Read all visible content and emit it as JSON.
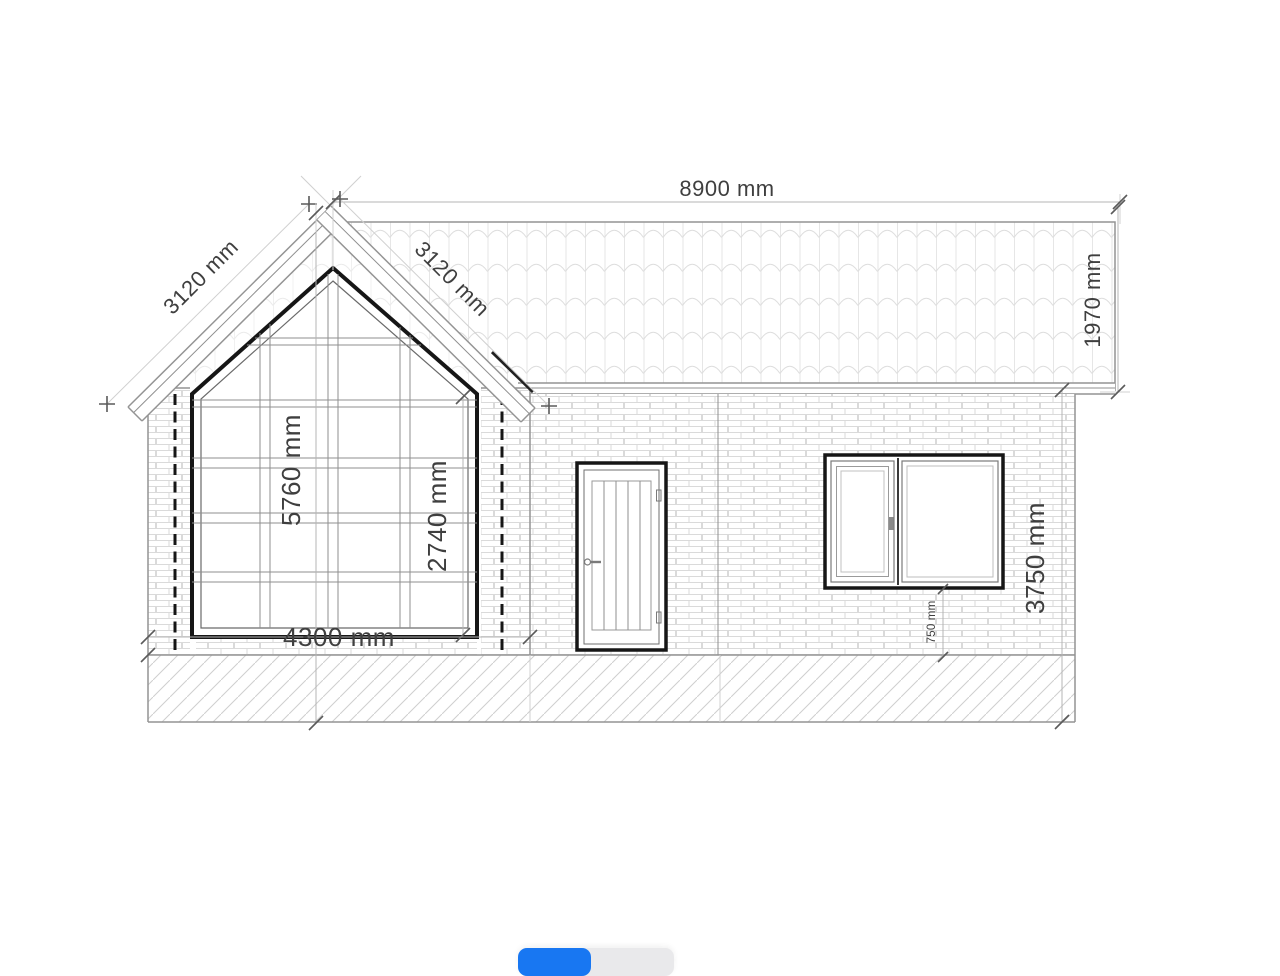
{
  "drawing": {
    "dimensions": {
      "ridge_width": "8900 mm",
      "slope_left": "3120 mm",
      "slope_right": "3120 mm",
      "roof_band_height": "1970 mm",
      "overall_height": "5760 mm",
      "window_height": "2740 mm",
      "gable_width": "4300 mm",
      "wall_height": "3750 mm",
      "sill_height": "750 mm"
    },
    "colors": {
      "outline_dark": "#161616",
      "line_medium": "#949494",
      "line_light": "#d0d0d0",
      "text": "#3f3f3f"
    }
  },
  "controls": {
    "segmented_control": {
      "selected_color": "#1877f2",
      "track_color": "#e9e9eb"
    }
  }
}
